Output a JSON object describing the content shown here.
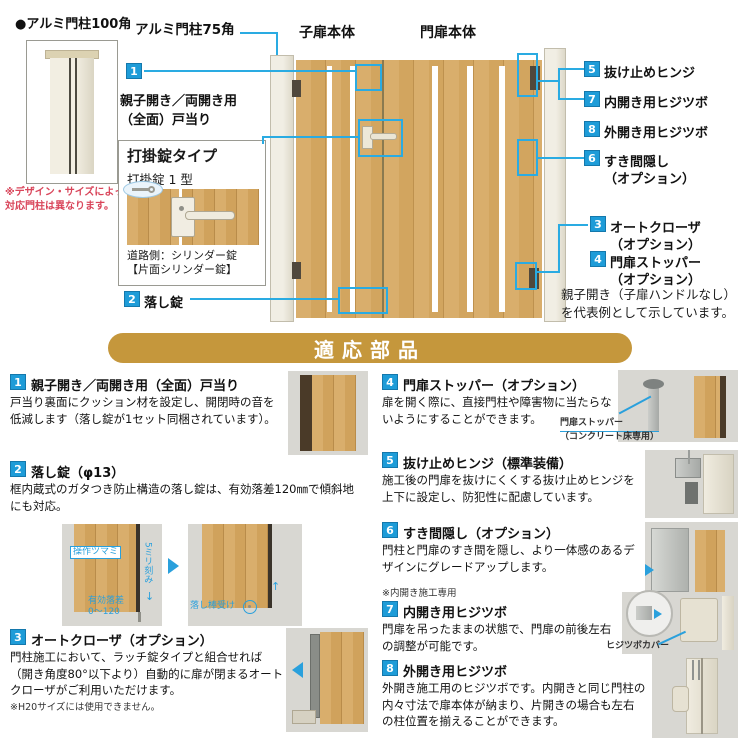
{
  "top": {
    "post100": {
      "label": "●アルミ門柱100角",
      "note1": "※デザイン・サイズによって",
      "note2": "対応門柱は異なります。"
    },
    "post75_label": "アルミ門柱75角",
    "gate": {
      "child_label": "子扉本体",
      "main_label": "門扉本体"
    },
    "callout1": {
      "num": "1",
      "label1": "親子開き／両開き用",
      "label2": "（全面）戸当り"
    },
    "lockbox": {
      "title": "打掛錠タイプ",
      "subtitle": "打掛錠 1 型",
      "cap1": "道路側：シリンダー錠",
      "cap2": "【片面シリンダー錠】"
    },
    "callout2": {
      "num": "2",
      "label": "落し錠"
    },
    "right_callouts": [
      {
        "num": "5",
        "label": "抜け止めヒンジ",
        "label2": ""
      },
      {
        "num": "7",
        "label": "内開き用ヒジツボ",
        "label2": ""
      },
      {
        "num": "8",
        "label": "外開き用ヒジツボ",
        "label2": ""
      },
      {
        "num": "6",
        "label": "すき間隠し",
        "label2": "（オプション）"
      },
      {
        "num": "3",
        "label": "オートクローザ",
        "label2": "（オプション）"
      },
      {
        "num": "4",
        "label": "門扉ストッパー",
        "label2": "（オプション）"
      }
    ],
    "note1": "親子開き（子扉ハンドルなし）",
    "note2": "を代表例として示しています。"
  },
  "banner": {
    "title": "適応部品"
  },
  "parts": [
    {
      "num": "1",
      "title": "親子開き／両開き用（全面）戸当り",
      "desc": "戸当り裏面にクッション材を設定し、開閉時の音を低減します（落し錠が1セット同梱されています）。"
    },
    {
      "num": "2",
      "title": "落し錠（φ13）",
      "desc": "框内蔵式のガタつき防止構造の落し錠は、有効落差120㎜で傾斜地にも対応。",
      "label_tsumami": "操作ツマミ",
      "label_kizami": "5ミリ刻み",
      "label_rakusa1": "有効落差",
      "label_rakusa2": "0〜120",
      "label_uke": "落し棒受け"
    },
    {
      "num": "3",
      "title": "オートクローザ（オプション）",
      "desc": "門柱施工において、ラッチ錠タイプと組合せれば（開き角度80°以下より）自動的に扉が閉まるオートクローザがご利用いただけます。",
      "note": "※H20サイズには使用できません。"
    },
    {
      "num": "4",
      "title": "門扉ストッパー（オプション）",
      "desc": "扉を開く際に、直接門柱や障害物に当たらないようにすることができます。",
      "caption1": "門扉ストッパー",
      "caption2": "（コンクリート床専用）"
    },
    {
      "num": "5",
      "title": "抜け止めヒンジ（標準装備）",
      "desc": "施工後の門扉を抜けにくくする抜け止めヒンジを上下に設定し、防犯性に配慮しています。"
    },
    {
      "num": "6",
      "title": "すき間隠し（オプション）",
      "desc": "門柱と門扉のすき間を隠し、より一体感のあるデザインにグレードアップします。",
      "note": "※内開き施工専用"
    },
    {
      "num": "7",
      "title": "内開き用ヒジツボ",
      "desc": "門扉を吊ったままの状態で、門扉の前後左右の調整が可能です。",
      "caption": "ヒジツボカバー"
    },
    {
      "num": "8",
      "title": "外開き用ヒジツボ",
      "desc": "外開き施工用のヒジツボです。内開きと同じ門柱の内々寸法で扉本体が納まり、片開きの場合も左右の柱位置を揃えることができます。"
    }
  ],
  "colors": {
    "accent_blue": "#1E9CD8",
    "line_blue": "#2AABE2",
    "banner_gold": "#C5973C",
    "note_red": "#D9455A"
  }
}
